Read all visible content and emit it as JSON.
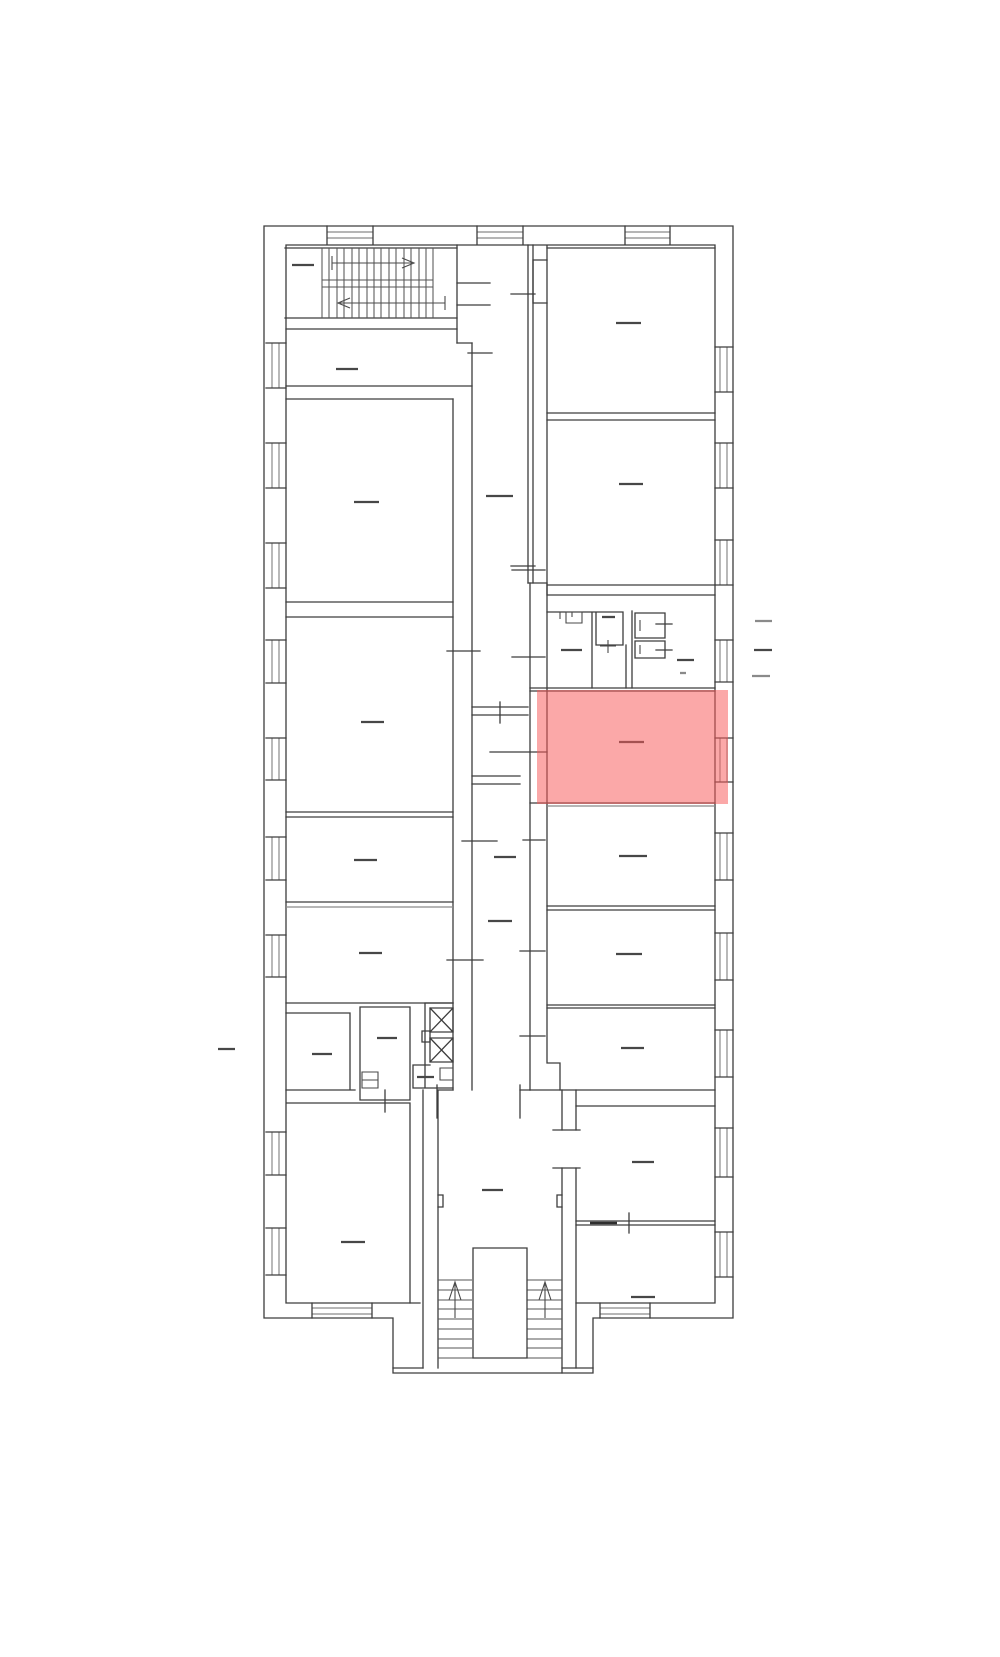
{
  "plan": {
    "colors": {
      "background": "#ffffff",
      "walls": "#3d3d3d",
      "details": "#8a8a8a",
      "labels": "#474747",
      "highlight": "#f75a5a"
    },
    "highlighted_room": {
      "x": 537,
      "y": 690,
      "width": 191,
      "height": 114,
      "fill": "#f75a5a",
      "opacity": 0.53
    },
    "label_dashes": [
      {
        "name": "stairhall-label",
        "x": 292,
        "y": 265,
        "len": 22
      },
      {
        "name": "vestibule-label",
        "x": 336,
        "y": 369,
        "len": 22
      },
      {
        "name": "room-left-1-label",
        "x": 354,
        "y": 502,
        "len": 25
      },
      {
        "name": "room-right-1-label",
        "x": 616,
        "y": 323,
        "len": 25
      },
      {
        "name": "room-right-2-label",
        "x": 619,
        "y": 484,
        "len": 24
      },
      {
        "name": "corridor-north-label",
        "x": 486,
        "y": 496,
        "len": 27
      },
      {
        "name": "room-left-2-label",
        "x": 361,
        "y": 722,
        "len": 23
      },
      {
        "name": "wc-left-label",
        "x": 561,
        "y": 650,
        "len": 21
      },
      {
        "name": "wc-middle-label",
        "x": 602,
        "y": 617,
        "len": 13
      },
      {
        "name": "wc-right-label",
        "x": 677,
        "y": 660,
        "len": 17
      },
      {
        "name": "highlighted-room-label",
        "x": 619,
        "y": 742,
        "len": 25
      },
      {
        "name": "room-right-3-label",
        "x": 619,
        "y": 856,
        "len": 28
      },
      {
        "name": "corridor-middle-label",
        "x": 494,
        "y": 857,
        "len": 22
      },
      {
        "name": "corridor-low-label",
        "x": 488,
        "y": 921,
        "len": 24
      },
      {
        "name": "room-left-3-label",
        "x": 354,
        "y": 860,
        "len": 23
      },
      {
        "name": "room-left-4-label",
        "x": 359,
        "y": 953,
        "len": 23
      },
      {
        "name": "room-right-4-label",
        "x": 616,
        "y": 954,
        "len": 26
      },
      {
        "name": "room-right-5-label",
        "x": 621,
        "y": 1048,
        "len": 23
      },
      {
        "name": "room-small-1-label",
        "x": 312,
        "y": 1054,
        "len": 20
      },
      {
        "name": "room-small-2-label",
        "x": 377,
        "y": 1038,
        "len": 20
      },
      {
        "name": "room-small-3-label",
        "x": 417,
        "y": 1077,
        "len": 17
      },
      {
        "name": "entrance-hall-label",
        "x": 482,
        "y": 1190,
        "len": 21
      },
      {
        "name": "room-bottom-left-label",
        "x": 341,
        "y": 1242,
        "len": 24
      },
      {
        "name": "room-right-6-label",
        "x": 632,
        "y": 1162,
        "len": 22
      },
      {
        "name": "room-right-7-label",
        "x": 631,
        "y": 1297,
        "len": 24
      },
      {
        "name": "outside-right-mark-1",
        "x": 755,
        "y": 621,
        "len": 17,
        "tone": "light"
      },
      {
        "name": "outside-right-mark-2",
        "x": 754,
        "y": 650,
        "len": 18
      },
      {
        "name": "outside-right-mark-3",
        "x": 752,
        "y": 676,
        "len": 18,
        "tone": "light"
      },
      {
        "name": "outside-left-mark",
        "x": 218,
        "y": 1049,
        "len": 17
      },
      {
        "name": "wc-small-mark",
        "x": 680,
        "y": 673,
        "len": 6,
        "tone": "light"
      }
    ],
    "windows": {
      "left_wall": [
        [
          343,
          388
        ],
        [
          443,
          488
        ],
        [
          543,
          588
        ],
        [
          640,
          683
        ],
        [
          738,
          780
        ],
        [
          837,
          880
        ],
        [
          935,
          977
        ],
        [
          1132,
          1175
        ],
        [
          1228,
          1275
        ]
      ],
      "right_wall": [
        [
          347,
          392
        ],
        [
          443,
          488
        ],
        [
          540,
          585
        ],
        [
          640,
          682
        ],
        [
          738,
          782
        ],
        [
          833,
          880
        ],
        [
          933,
          980
        ],
        [
          1030,
          1077
        ],
        [
          1128,
          1177
        ],
        [
          1232,
          1277
        ]
      ],
      "top_wall": [
        [
          327,
          373
        ],
        [
          477,
          523
        ],
        [
          625,
          670
        ]
      ],
      "bottom_wall": [
        [
          312,
          372
        ],
        [
          600,
          650
        ]
      ]
    }
  }
}
